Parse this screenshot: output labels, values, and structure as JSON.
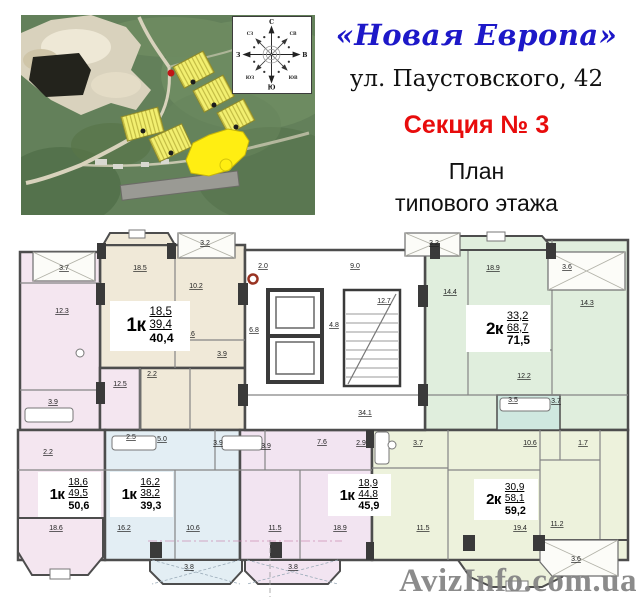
{
  "header": {
    "title": "«Новая Европа»",
    "address": "ул. Паустовского, 42",
    "section": "Секция № 3",
    "subtitle_line1": "План",
    "subtitle_line2": "типового этажа",
    "title_color": "#1d18c8",
    "section_color": "#e80c0c"
  },
  "map": {
    "description": "satellite-photo-with-highlighted-buildings",
    "highlight_color": "#ffee12",
    "building_fill": "#f2ef70",
    "compass": {
      "n": "С",
      "s": "Ю",
      "e": "В",
      "w": "З",
      "ne": "СВ",
      "nw": "СЗ",
      "se": "ЮВ",
      "sw": "ЮЗ"
    }
  },
  "plan": {
    "apartments": [
      {
        "id": "apt-1k-404",
        "type": "1к",
        "living": "18,5",
        "area": "39,4",
        "total": "40,4",
        "color": "#f0e9d8"
      },
      {
        "id": "apt-2k-715",
        "type": "2к",
        "living": "33,2",
        "area": "68,7",
        "total": "71,5",
        "color": "#e0eedd"
      },
      {
        "id": "apt-1k-506",
        "type": "1к",
        "living": "18,6",
        "area": "49,5",
        "total": "50,6",
        "color": "#f4e6f0"
      },
      {
        "id": "apt-1k-393",
        "type": "1к",
        "living": "16,2",
        "area": "38,2",
        "total": "39,3",
        "color": "#e3eef4"
      },
      {
        "id": "apt-1k-459",
        "type": "1к",
        "living": "18,9",
        "area": "44,8",
        "total": "45,9",
        "color": "#f2e4f1"
      },
      {
        "id": "apt-2k-592",
        "type": "2к",
        "living": "30,9",
        "area": "58,1",
        "total": "59,2",
        "color": "#edf2dc"
      }
    ],
    "bath_color": "#cfe8e0",
    "room_labels": [
      {
        "t": "3.7",
        "x": 64,
        "y": 270
      },
      {
        "t": "12.3",
        "x": 62,
        "y": 313
      },
      {
        "t": "3.9",
        "x": 53,
        "y": 404
      },
      {
        "t": "12.5",
        "x": 120,
        "y": 386
      },
      {
        "t": "18.5",
        "x": 140,
        "y": 270
      },
      {
        "t": "10.2",
        "x": 196,
        "y": 288
      },
      {
        "t": "4.6",
        "x": 190,
        "y": 336
      },
      {
        "t": "2.2",
        "x": 152,
        "y": 376
      },
      {
        "t": "3.9",
        "x": 222,
        "y": 356
      },
      {
        "t": "3.2",
        "x": 205,
        "y": 245
      },
      {
        "t": "2.0",
        "x": 263,
        "y": 268
      },
      {
        "t": "9.0",
        "x": 355,
        "y": 268
      },
      {
        "t": "12.7",
        "x": 384,
        "y": 303
      },
      {
        "t": "4.8",
        "x": 334,
        "y": 327
      },
      {
        "t": "6.8",
        "x": 254,
        "y": 332
      },
      {
        "t": "34.1",
        "x": 365,
        "y": 415
      },
      {
        "t": "3.2",
        "x": 434,
        "y": 245
      },
      {
        "t": "18.9",
        "x": 493,
        "y": 270
      },
      {
        "t": "14.4",
        "x": 450,
        "y": 294
      },
      {
        "t": "3.6",
        "x": 567,
        "y": 269
      },
      {
        "t": "14.3",
        "x": 587,
        "y": 305
      },
      {
        "t": "12.2",
        "x": 524,
        "y": 378
      },
      {
        "t": "3.5",
        "x": 513,
        "y": 402
      },
      {
        "t": "3.7",
        "x": 556,
        "y": 403
      },
      {
        "t": "2.2",
        "x": 48,
        "y": 454
      },
      {
        "t": "18.6",
        "x": 56,
        "y": 530
      },
      {
        "t": "2.5",
        "x": 131,
        "y": 439
      },
      {
        "t": "5.0",
        "x": 162,
        "y": 441
      },
      {
        "t": "3.9",
        "x": 218,
        "y": 445
      },
      {
        "t": "16.2",
        "x": 124,
        "y": 530
      },
      {
        "t": "10.6",
        "x": 193,
        "y": 530
      },
      {
        "t": "3.8",
        "x": 189,
        "y": 569
      },
      {
        "t": "3.9",
        "x": 266,
        "y": 448
      },
      {
        "t": "7.6",
        "x": 322,
        "y": 444
      },
      {
        "t": "2.9",
        "x": 361,
        "y": 445
      },
      {
        "t": "11.5",
        "x": 275,
        "y": 530
      },
      {
        "t": "18.9",
        "x": 340,
        "y": 530
      },
      {
        "t": "3.8",
        "x": 293,
        "y": 569
      },
      {
        "t": "3.7",
        "x": 418,
        "y": 445
      },
      {
        "t": "10.6",
        "x": 530,
        "y": 445
      },
      {
        "t": "1.7",
        "x": 583,
        "y": 445
      },
      {
        "t": "11.5",
        "x": 423,
        "y": 530
      },
      {
        "t": "19.4",
        "x": 520,
        "y": 530
      },
      {
        "t": "11.2",
        "x": 557,
        "y": 526
      },
      {
        "t": "3.6",
        "x": 576,
        "y": 561
      }
    ]
  },
  "watermark": {
    "text": "AvizInfo.com.ua",
    "color": "#8d8d8d"
  }
}
